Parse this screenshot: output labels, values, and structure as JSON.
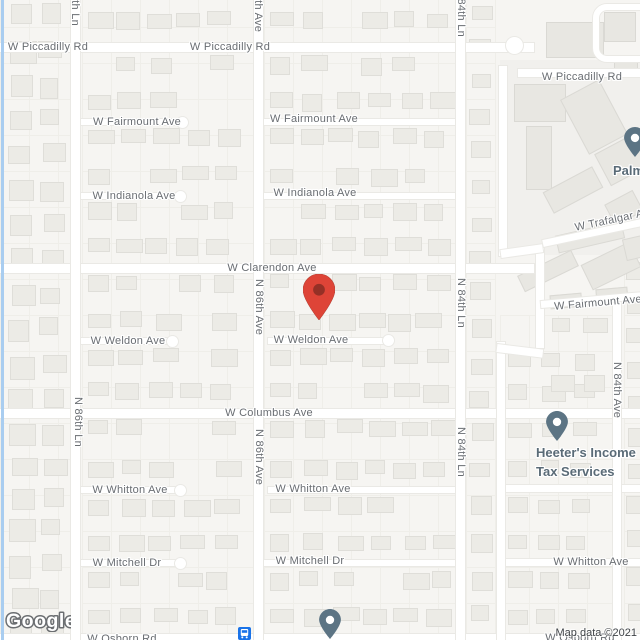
{
  "attribution": {
    "text": "Map data ©2021"
  },
  "logo": {
    "text": "Google"
  },
  "streets": {
    "piccadilly": "W Piccadilly Rd",
    "fairmount": "W Fairmount Ave",
    "indianola": "W Indianola Ave",
    "clarendon": "W Clarendon Ave",
    "weldon": "W Weldon Ave",
    "columbus": "W Columbus Ave",
    "whitton": "W Whitton Ave",
    "mitchell": "W Mitchell Dr",
    "osborn": "W Osborn Rd",
    "trafalgar": "W Trafalgar Ave",
    "n_86th_ln": "N 86th Ln",
    "n_86th_ave": "N 86th Ave",
    "n_84th_ln": "N 84th Ln",
    "n_84th_ave": "N 84th Ave"
  },
  "pois": {
    "palm": {
      "label": "Palm"
    },
    "heeters": {
      "line1": "Heeter's Income",
      "line2": "Tax Services"
    }
  },
  "markers": {
    "destination": {
      "fill": "#DE4437",
      "inner": "#8E2F25"
    },
    "poi_pin": {
      "fill": "#5C7484"
    },
    "transit_bus": {
      "fill": "#1A73E8"
    }
  },
  "colors": {
    "canal": "#A9CDF0",
    "road": "#FFFFFF",
    "street_label": "#696D72",
    "poi_label": "#5A6B77"
  }
}
